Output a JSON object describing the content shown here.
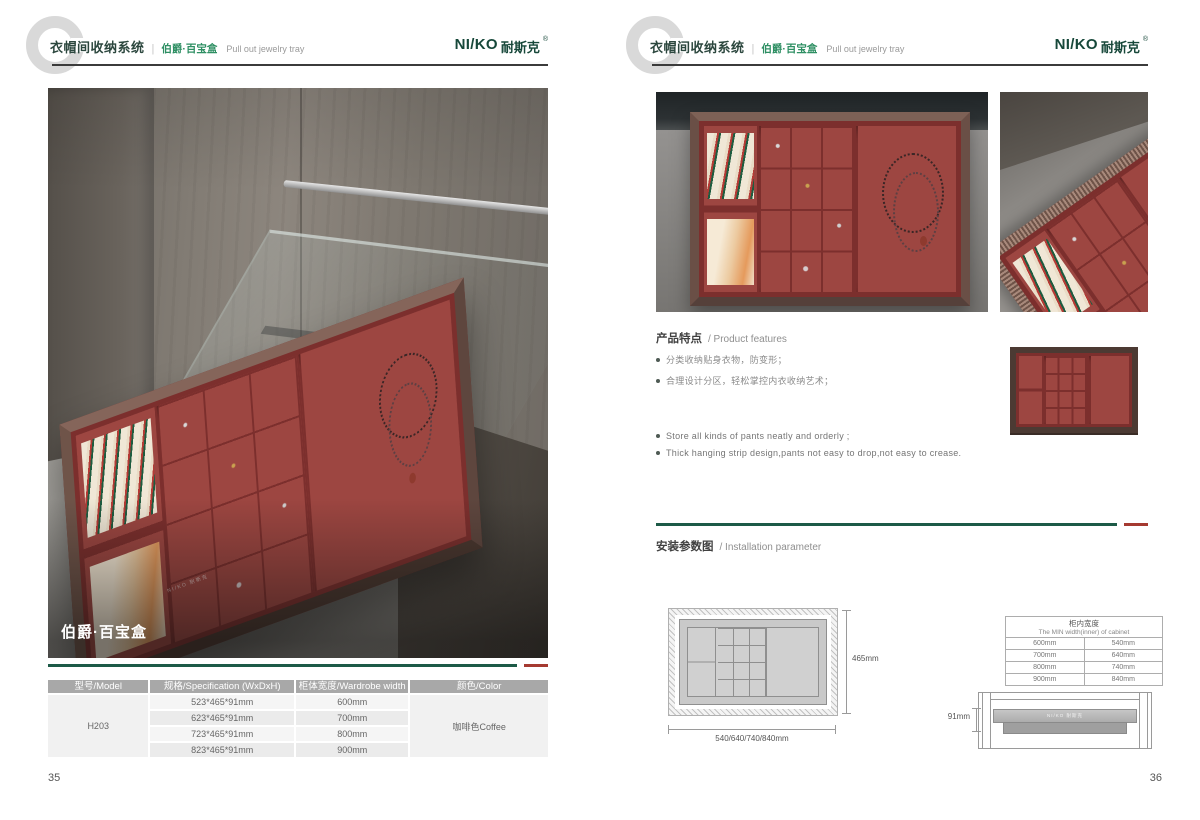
{
  "header": {
    "category": "衣帽间收纳系统",
    "separator": "|",
    "series": "伯爵·百宝盒",
    "subtitle_en": "Pull out jewelry tray",
    "logo": {
      "latin": "NI/KO",
      "zh": "耐斯克",
      "reg": "®"
    }
  },
  "colors": {
    "accent_green": "#1d5a47",
    "accent_red": "#a53a31",
    "brand_green": "#17483a",
    "tray_red": "#9c4540",
    "table_header_gray": "#a8a8a8"
  },
  "page_left": {
    "photo_label": "伯爵·百宝盒",
    "tray_brand": "NI/KO 耐斯克",
    "table": {
      "headers": [
        "型号/Model",
        "规格/Specification (WxDxH)",
        "柜体宽度/Wardrobe width",
        "颜色/Color"
      ],
      "model": "H203",
      "rows": [
        {
          "spec": "523*465*91mm",
          "width": "600mm"
        },
        {
          "spec": "623*465*91mm",
          "width": "700mm"
        },
        {
          "spec": "723*465*91mm",
          "width": "800mm"
        },
        {
          "spec": "823*465*91mm",
          "width": "900mm"
        }
      ],
      "color": "咖啡色Coffee"
    },
    "page_number": "35"
  },
  "page_right": {
    "features": {
      "title_zh": "产品特点",
      "title_en": "/ Product features",
      "bullets_zh": [
        "分类收纳贴身衣物，防变形；",
        "合理设计分区，轻松掌控内衣收纳艺术；"
      ],
      "bullets_en": [
        "Store all kinds of pants neatly and orderly ;",
        "Thick hanging strip design,pants not easy to drop,not easy to crease."
      ]
    },
    "installation": {
      "title_zh": "安装参数图",
      "title_en": "/ Installation parameter",
      "top_view": {
        "depth_label": "465mm",
        "width_label": "540/640/740/840mm"
      },
      "min_width_table": {
        "header_zh": "柜内宽度",
        "header_en": "The MIN width(inner) of cabinet",
        "rows": [
          [
            "600mm",
            "540mm"
          ],
          [
            "700mm",
            "640mm"
          ],
          [
            "800mm",
            "740mm"
          ],
          [
            "900mm",
            "840mm"
          ]
        ]
      },
      "side_view": {
        "height_label": "91mm",
        "brand_text": "NI/KO 耐斯克"
      }
    },
    "page_number": "36"
  }
}
